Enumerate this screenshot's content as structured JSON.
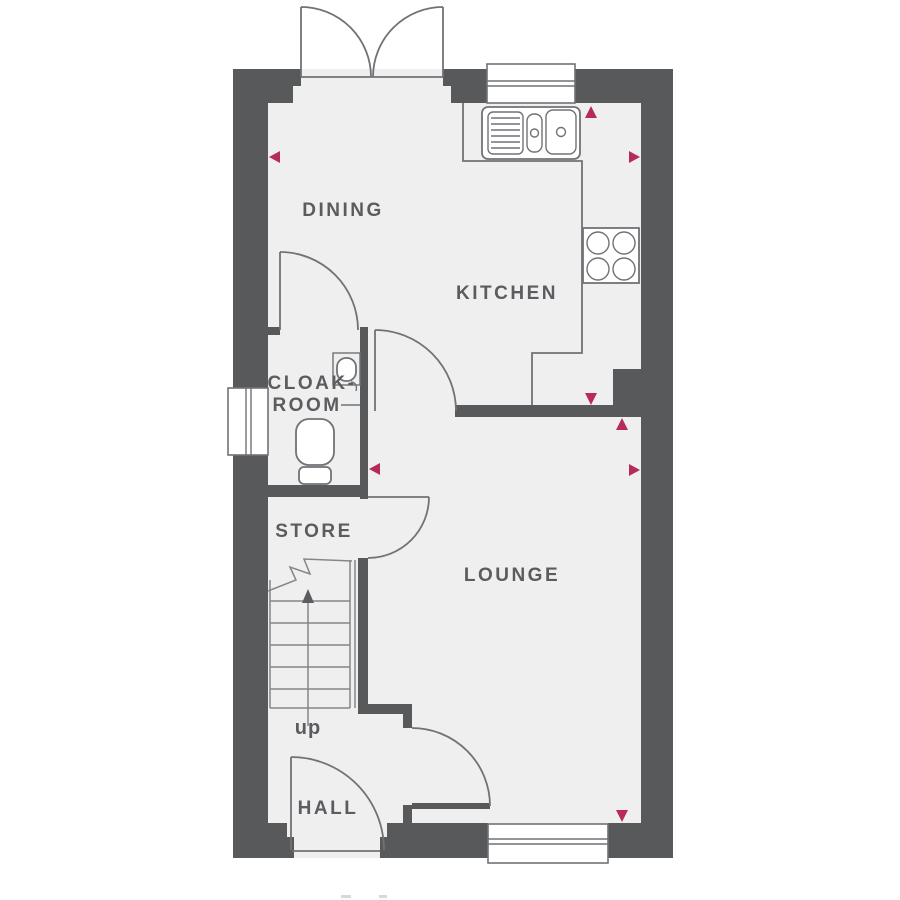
{
  "plan": {
    "kind": "house ground floor plan",
    "rooms": {
      "dining": {
        "label": "DINING"
      },
      "kitchen": {
        "label": "KITCHEN"
      },
      "cloakroom": {
        "label_line1": "CLOAK-",
        "label_line2": "ROOM"
      },
      "store": {
        "label": "STORE"
      },
      "lounge": {
        "label": "LOUNGE"
      },
      "hall": {
        "label": "HALL"
      }
    },
    "stairs": {
      "label": "up"
    },
    "fixtures": [
      "french-doors-dining",
      "kitchen-window",
      "sink-with-drainer",
      "hob-four-rings",
      "cloakroom-window",
      "toilet",
      "wash-basin",
      "lounge-window",
      "front-door",
      "cloakroom-door",
      "kitchen-door",
      "store-door",
      "lounge-door"
    ],
    "measurement_markers": {
      "count": 8,
      "directions": [
        "left",
        "up",
        "right",
        "left",
        "down",
        "up",
        "right",
        "down"
      ]
    }
  },
  "colors": {
    "wall": "#58595b",
    "floor": "#f0eff0",
    "line": "#717276",
    "label": "#5b5c60",
    "marker": "#b92b57",
    "background": "#ffffff"
  }
}
